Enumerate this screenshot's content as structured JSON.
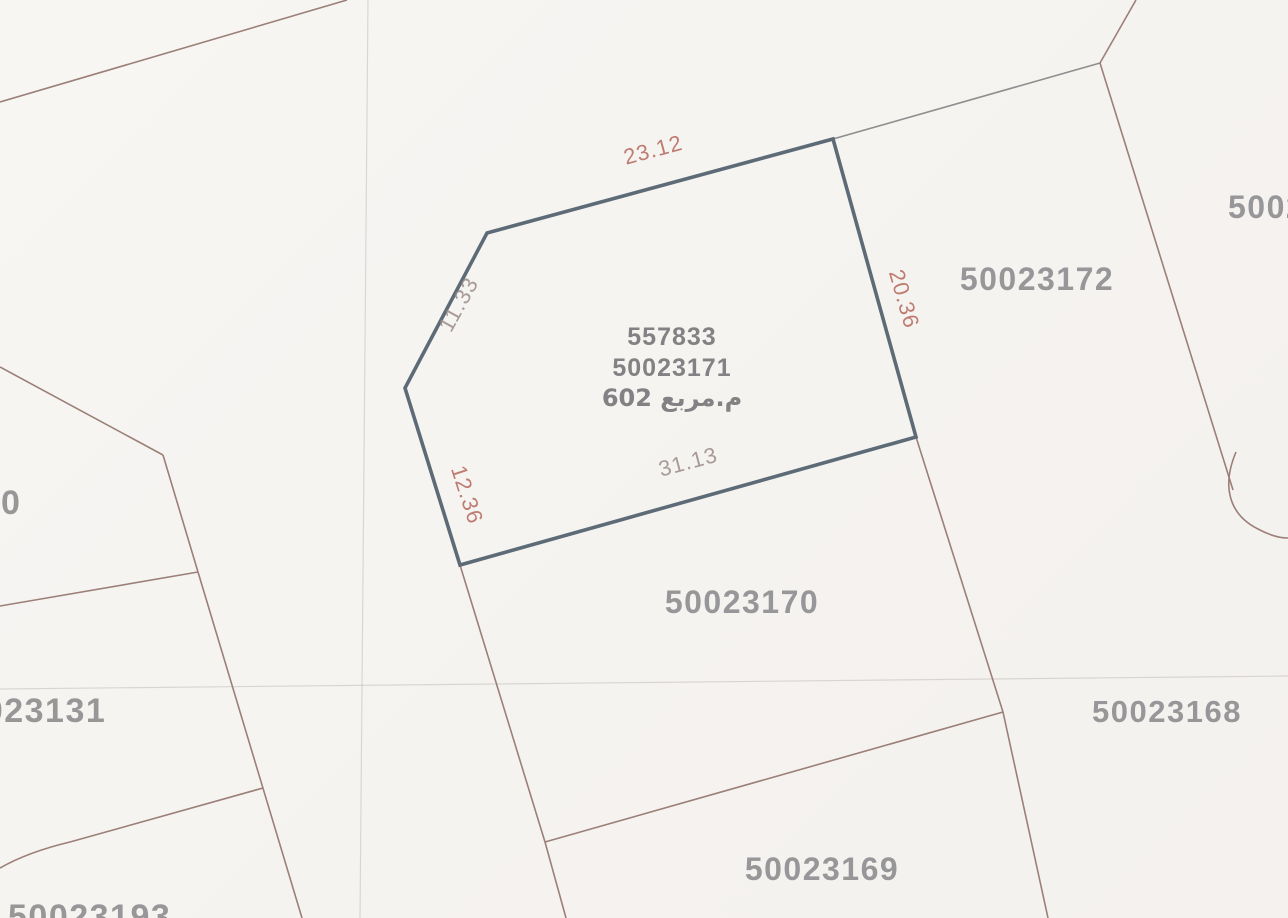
{
  "map": {
    "type": "cadastral-parcel-plan",
    "selected_parcel": {
      "plot_number": "557833",
      "parcel_number": "50023171",
      "area_label": "602 م.مربع",
      "dimensions": {
        "top_edge": "23.12",
        "upper_left_edge": "11.33",
        "lower_left_edge": "12.36",
        "bottom_edge": "31.13",
        "right_edge": "20.36"
      }
    },
    "neighbor_parcels": {
      "right_of_selected": "50023172",
      "far_right_partial": "5002",
      "below_selected": "50023170",
      "lower_right": "50023168",
      "bottom_center": "50023169",
      "left_partial": "50023131",
      "left_edge_partial": "0",
      "bottom_left_partial": "50023193"
    },
    "colors": {
      "selected_outline": "#5d6b77",
      "boundary_line": "#9b7f78",
      "boundary_line_gray": "#8e8e90",
      "dimension_red": "#b5685c",
      "dimension_gray": "#9a8b89",
      "parcel_label_gray": "#7d7d80",
      "center_label_gray": "#69696c",
      "scan_fold": "rgba(175,170,165,0.40)",
      "paper": "#f6f4f1"
    }
  }
}
